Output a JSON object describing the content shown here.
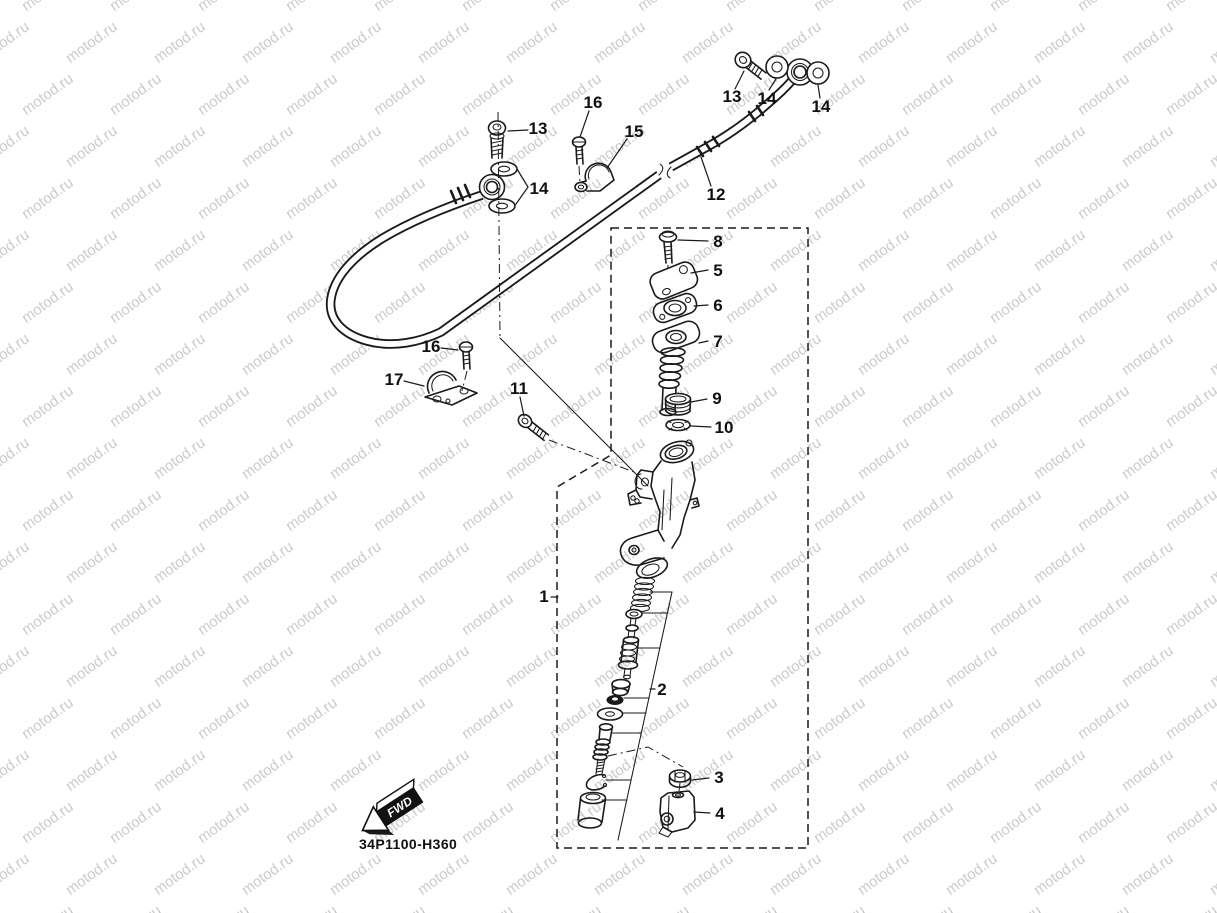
{
  "watermark": {
    "text": "motod.ru",
    "color": "#cbcbcb"
  },
  "page": {
    "background": "#ffffff",
    "line_color": "#1a1a1a"
  },
  "diagram": {
    "code": "34P1100-H360",
    "fwd_label": "FWD",
    "callouts": {
      "c1": "1",
      "c2": "2",
      "c3": "3",
      "c4": "4",
      "c5": "5",
      "c6": "6",
      "c7": "7",
      "c8": "8",
      "c9": "9",
      "c10": "10",
      "c11": "11",
      "c12": "12",
      "c13_left": "13",
      "c13_top": "13",
      "c14_left": "14",
      "c14_top_a": "14",
      "c14_top_b": "14",
      "c15": "15",
      "c16_top": "16",
      "c16_mid": "16",
      "c17": "17"
    }
  }
}
